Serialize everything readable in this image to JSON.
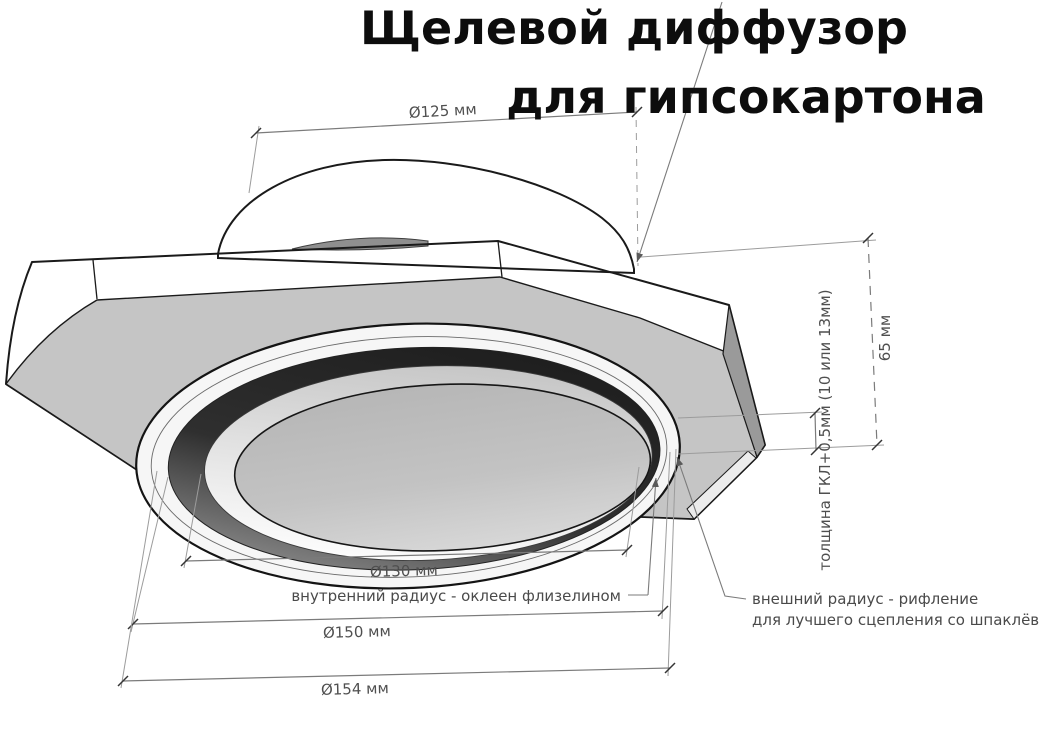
{
  "title": {
    "line1": "Щелевой диффузор",
    "line2": "для гипсокартона"
  },
  "dimensions": {
    "collar_diameter": "Ø125 мм",
    "inner_diameter": "Ø130 мм",
    "trim_diameter": "Ø150 мм",
    "outer_diameter": "Ø154 мм",
    "height": "65 мм",
    "board_thickness": "толщина ГКЛ+0,5мм (10 или 13мм)"
  },
  "annotations": {
    "inner_radius": "внутренний радиус - оклеен флизелином",
    "outer_radius_line1": "внешний радиус - рифление",
    "outer_radius_line2": "для лучшего сцепления со шпаклёвкой"
  },
  "colors": {
    "background": "#ffffff",
    "outline": "#1a1a1a",
    "dimension_lines": "#7b7b7b",
    "dimension_text": "#4f4f4f",
    "plate_underside": "#c5c5c5",
    "plate_side_facet": "#9a9a9a",
    "slot_dark": "#2d2d2d",
    "title_text": "#0d0d0d"
  }
}
